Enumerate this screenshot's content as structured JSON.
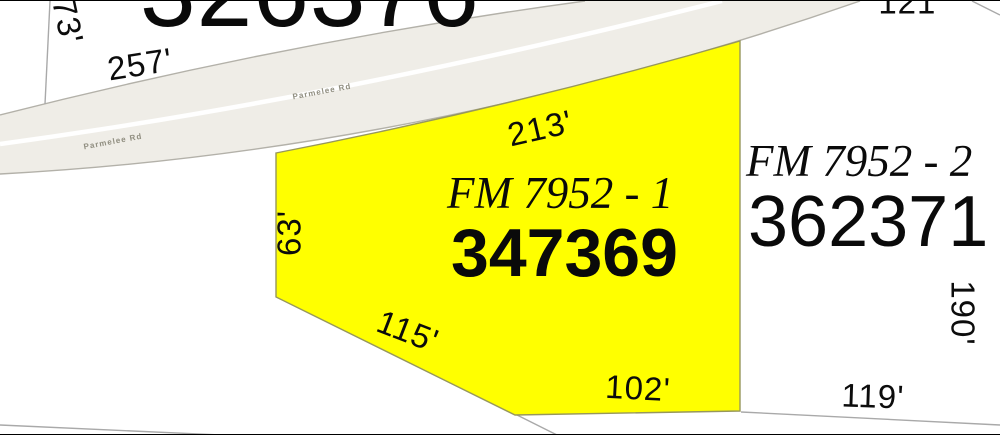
{
  "map": {
    "type": "parcel-plat-map",
    "road": {
      "name": "Parmelee Rd",
      "fill": "#efede7",
      "edge_color": "#b3b1a9",
      "stripe_color": "#ffffff",
      "label_positions": [
        {
          "x": 113,
          "y": 141,
          "rot": -10.5
        },
        {
          "x": 322,
          "y": 91,
          "rot": -10.5
        }
      ]
    },
    "highlight_color": "#ffff00",
    "boundary_color": "#a9a9a9",
    "parcels": [
      {
        "id": "326376",
        "label": "",
        "highlighted": false
      },
      {
        "id": "347369",
        "label": "FM 7952 - 1",
        "highlighted": true
      },
      {
        "id": "362371",
        "label": "FM 7952 - 2",
        "highlighted": false
      }
    ],
    "dimension_labels": [
      {
        "text": "73'",
        "x": 68,
        "y": 20,
        "rot": 78
      },
      {
        "text": "257'",
        "x": 140,
        "y": 63,
        "rot": -9
      },
      {
        "text": "213'",
        "x": 540,
        "y": 127,
        "rot": -13
      },
      {
        "text": "63'",
        "x": 289,
        "y": 232,
        "rot": -90
      },
      {
        "text": "115'",
        "x": 408,
        "y": 330,
        "rot": 21
      },
      {
        "text": "102'",
        "x": 638,
        "y": 387,
        "rot": 3
      },
      {
        "text": "121'",
        "x": 911,
        "y": 1,
        "rot": 0
      },
      {
        "text": "190'",
        "x": 963,
        "y": 312,
        "rot": 90
      },
      {
        "text": "119'",
        "x": 873,
        "y": 395,
        "rot": 2
      }
    ]
  }
}
